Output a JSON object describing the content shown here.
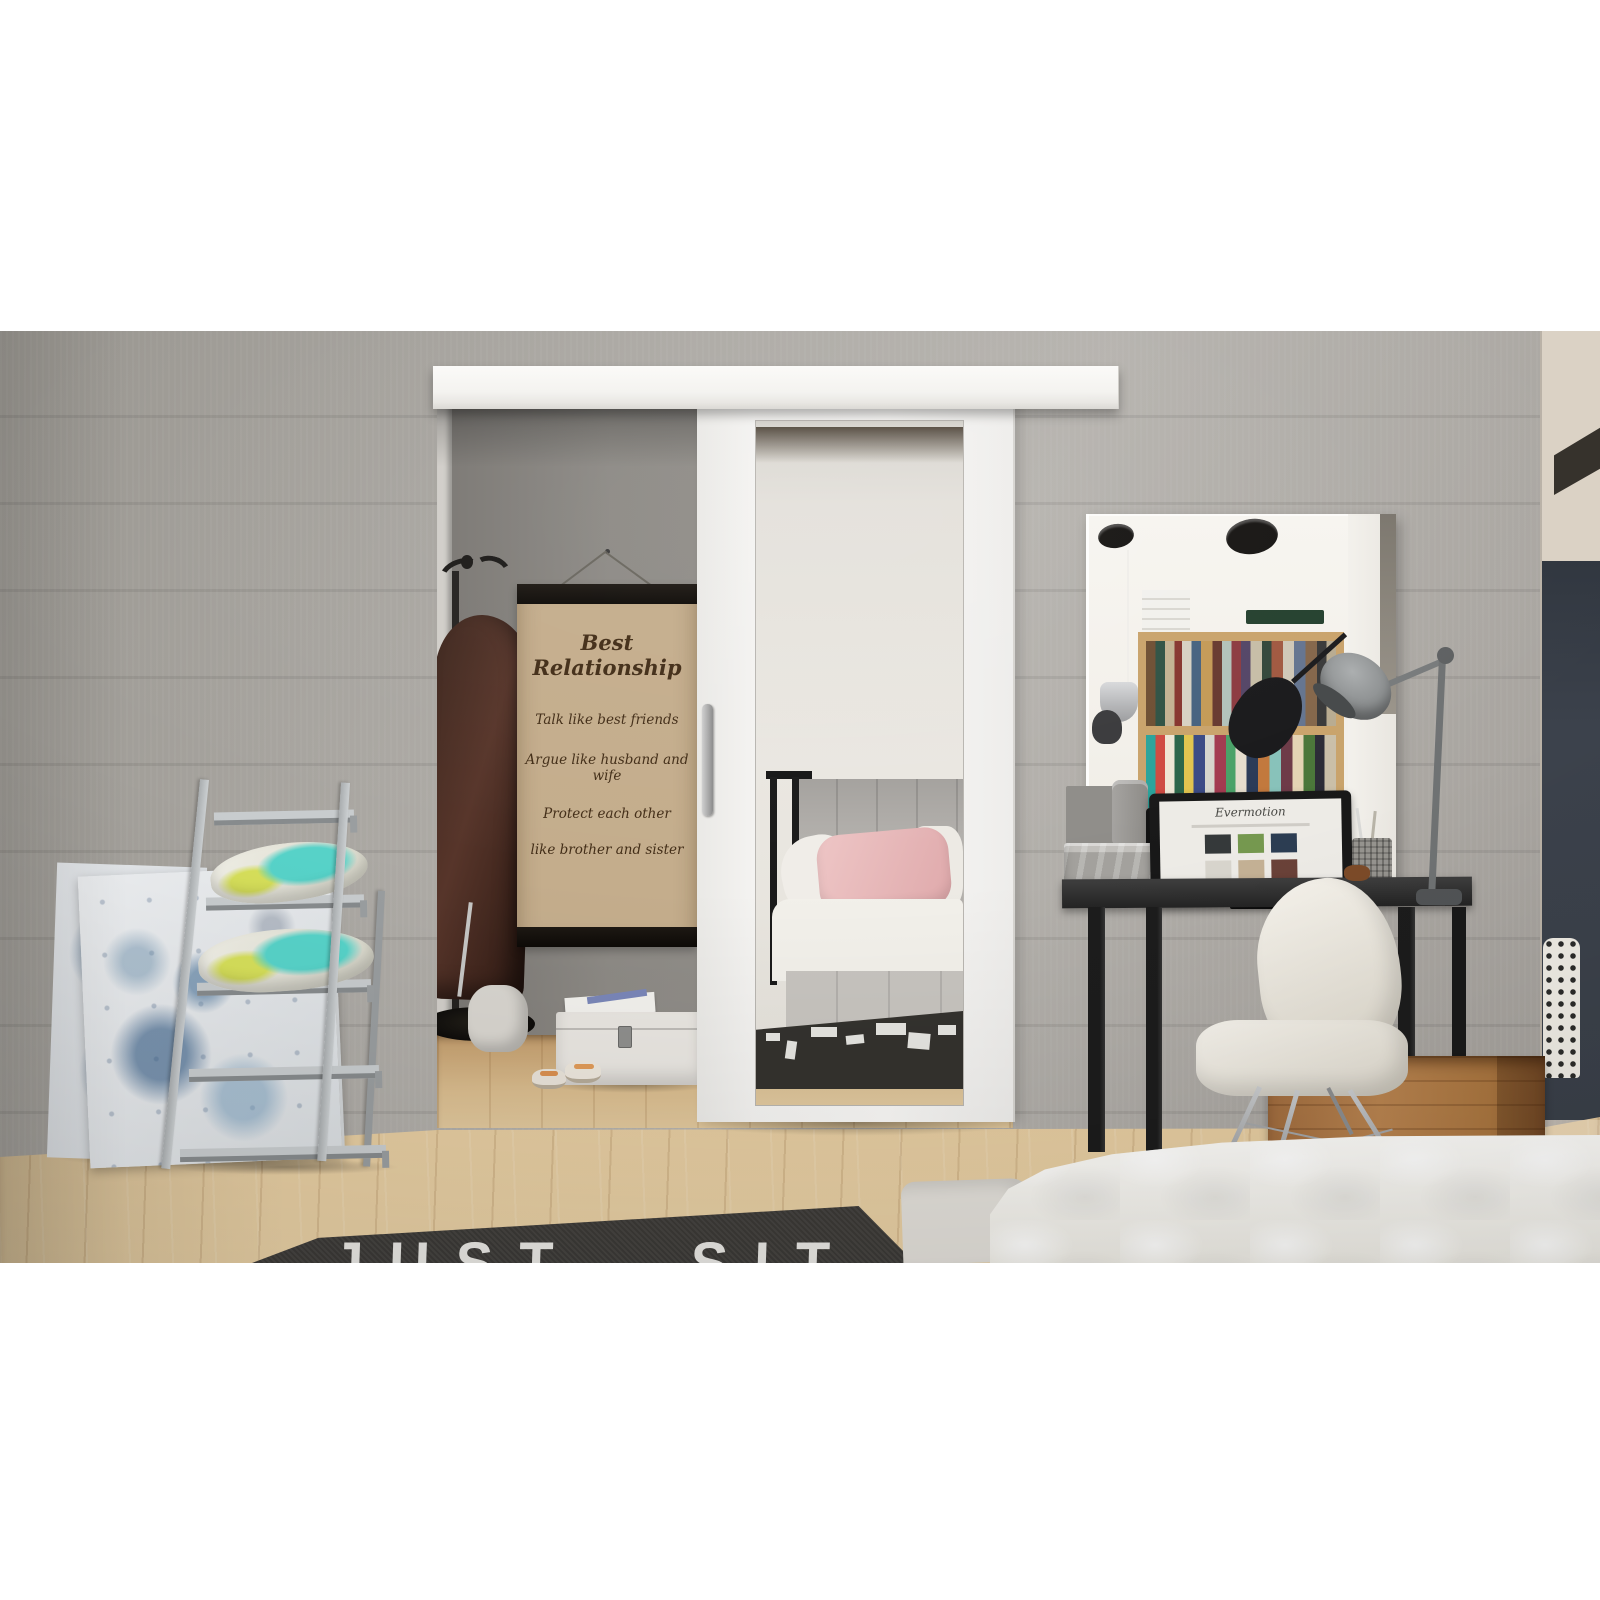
{
  "scene": {
    "type": "interior-photograph",
    "subject": "White sliding door with tall mirror hung on a wall-mounted rail, in a grey concrete-walled bedroom with oak floor",
    "regions": [
      "wardrobe alcove with coat rack, quote poster, white storage chest, cloth bag and sandals",
      "black vanity desk with frameless mirror reflecting a bookshelf, laptop, camera, metal trunk, pen cup and grey task lamp",
      "white shell chair with chrome eiffel base",
      "grey ladder shelf with two patterned pillows and abstract blue canvases leaning on the wall",
      "wooden crate with striped and polka-dot rolled textiles",
      "white quilted bed in the foreground and dark lettered rug",
      "hallway opening with dark navy wall at the right edge"
    ]
  },
  "poster": {
    "title": "Best Relationship",
    "lines": [
      "Talk like best friends",
      "Argue like husband and wife",
      "Protect each other",
      "like brother and sister"
    ]
  },
  "rug": {
    "text": "JUST SIT"
  },
  "laptop_screen": {
    "logo": "Evermotion"
  },
  "palette": {
    "letterbox": "#ffffff",
    "wall_grey": "#a9a6a1",
    "alcove_grey": "#8d8a85",
    "floor_oak": "#d9bc8e",
    "door_white": "#f4f3f0",
    "desk_black": "#272727",
    "hallway_navy": "#3a4049",
    "crate_wood": "#b07a49",
    "pillow_teal": "#57d3c9",
    "pillow_lime": "#d6df5a",
    "rug_black": "#3b3936",
    "pink_pillow": "#e8b8ba"
  }
}
